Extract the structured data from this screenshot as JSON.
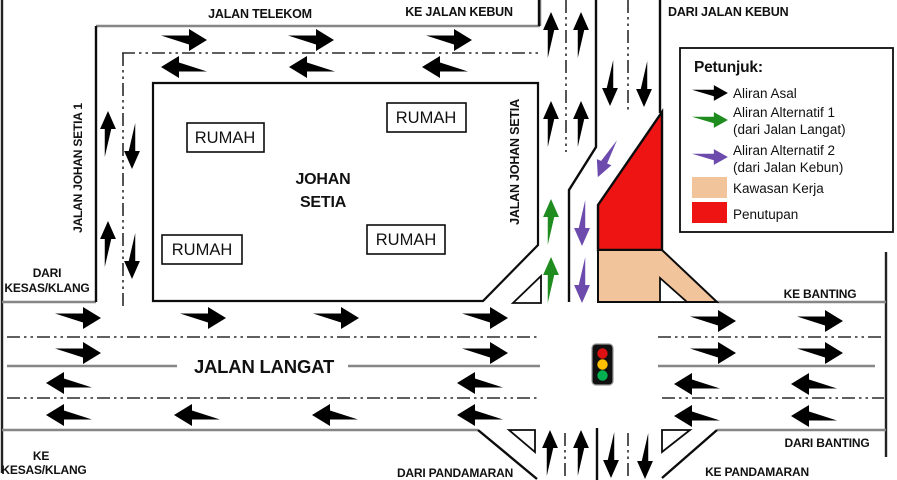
{
  "colors": {
    "flow_original": "#000000",
    "flow_alt1": "#1E8C1E",
    "flow_alt2": "#6C4BAD",
    "work_area": "#F2C49C",
    "closure": "#EE1414",
    "signal_red": "#DD1111",
    "signal_amber": "#FFC000",
    "signal_green": "#00B050"
  },
  "map": {
    "labels": {
      "jalan_telekom": "JALAN TELEKOM",
      "ke_jalan_kebun": "KE JALAN KEBUN",
      "dari_jalan_kebun": "DARI JALAN KEBUN",
      "jalan_johan_setia_1": "JALAN JOHAN SETIA 1",
      "jalan_johan_setia": "JALAN JOHAN SETIA",
      "johan_setia_line1": "JOHAN",
      "johan_setia_line2": "SETIA",
      "rumah": "RUMAH",
      "dari_kesas_line1": "DARI",
      "dari_kesas_line2": "KESAS/KLANG",
      "ke_kesas_line1": "KE",
      "ke_kesas_line2": "KESAS/KLANG",
      "jalan_langat": "JALAN LANGAT",
      "ke_banting": "KE BANTING",
      "dari_banting": "DARI BANTING",
      "dari_pandamaran": "DARI PANDAMARAN",
      "ke_pandamaran": "KE PANDAMARAN"
    }
  },
  "legend": {
    "title": "Petunjuk:",
    "items": [
      {
        "label": "Aliran Asal"
      },
      {
        "line1": "Aliran Alternatif 1",
        "line2": "(dari Jalan Langat)"
      },
      {
        "line1": "Aliran Alternatif 2",
        "line2": "(dari Jalan Kebun)"
      },
      {
        "label": "Kawasan Kerja"
      },
      {
        "label": "Penutupan"
      }
    ]
  }
}
